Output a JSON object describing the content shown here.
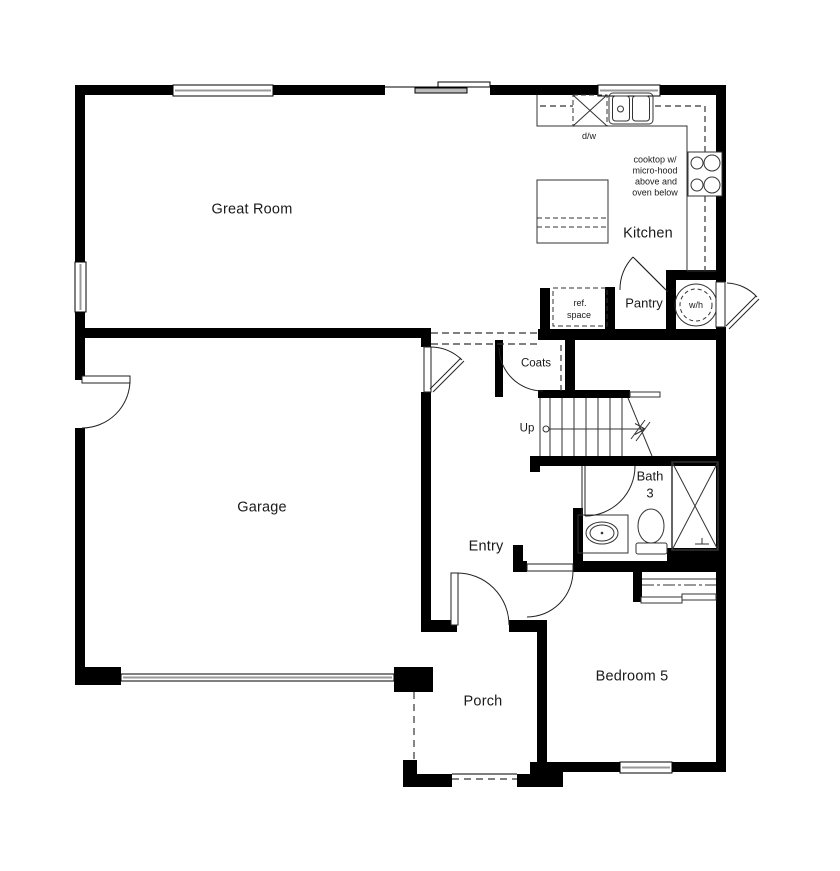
{
  "plan_type": "first-floor residential floor plan",
  "colors": {
    "wall": "#000000",
    "line": "#333333",
    "light_line": "#999999",
    "background": "#ffffff",
    "text": "#1a1a1a"
  },
  "rooms": {
    "great_room": {
      "label": "Great Room"
    },
    "kitchen": {
      "label": "Kitchen"
    },
    "garage": {
      "label": "Garage"
    },
    "entry": {
      "label": "Entry"
    },
    "bedroom5": {
      "label": "Bedroom 5"
    },
    "porch": {
      "label": "Porch"
    },
    "pantry": {
      "label": "Pantry"
    },
    "coats": {
      "label": "Coats"
    },
    "bath3": {
      "line1": "Bath",
      "line2": "3"
    }
  },
  "annotations": {
    "dishwasher": "d/w",
    "water_heater": "w/h",
    "stairs_direction": "Up",
    "ref_space": {
      "line1": "ref.",
      "line2": "space"
    },
    "cooktop_note": {
      "line1": "cooktop w/",
      "line2": "micro-hood",
      "line3": "above and",
      "line4": "oven below"
    }
  },
  "symbols": [
    "window",
    "sliding-glass-door",
    "door-swing-arc",
    "stairs-up",
    "dishwasher",
    "double-sink",
    "cooktop",
    "kitchen-island",
    "refrigerator-space",
    "water-heater",
    "shower",
    "toilet",
    "vanity-sink",
    "garage-door",
    "closet-shelf-rod"
  ]
}
